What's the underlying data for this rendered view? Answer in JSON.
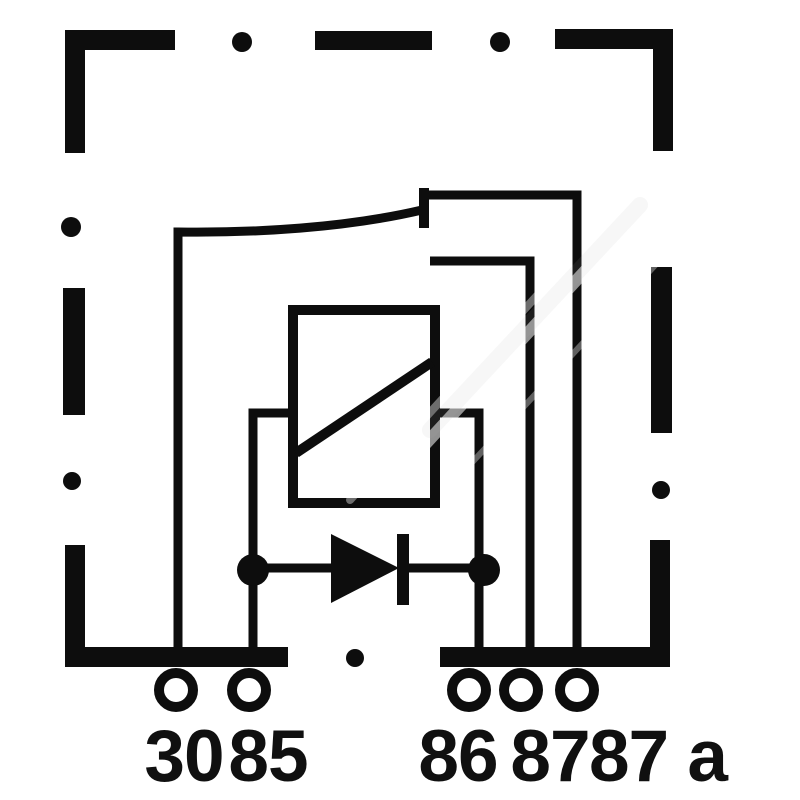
{
  "figure": {
    "name": "automotive-relay-wiring-diagram",
    "description": "Relay internal circuit: coil with parallel suppression diode, changeover contact from terminal 30 resting on 87a, dashed housing outline",
    "colors": {
      "ink": "#0d0d0d",
      "background": "#ffffff",
      "watermark": "#c8c8c8"
    },
    "terminals": [
      {
        "id": "30",
        "label": "30"
      },
      {
        "id": "85",
        "label": "85"
      },
      {
        "id": "86",
        "label": "86"
      },
      {
        "id": "87",
        "label": "87"
      },
      {
        "id": "87a",
        "label": "87 a"
      }
    ],
    "components": {
      "housing": "dashed-housing-outline",
      "coil": "relay-coil",
      "diode": "suppression-diode",
      "contact": "changeover-contact-30-87a-87"
    }
  }
}
